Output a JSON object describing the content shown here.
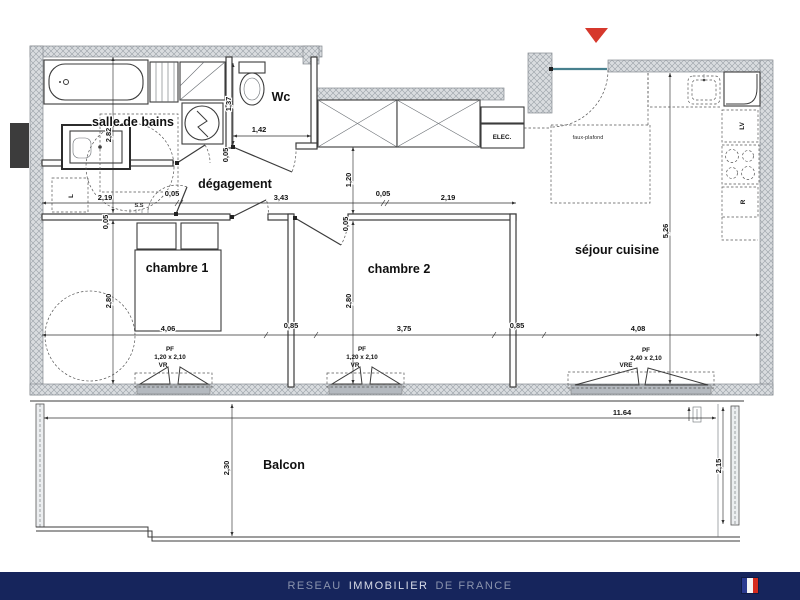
{
  "page": {
    "background": "#ffffff"
  },
  "entrance_marker": {
    "color": "#d6382c"
  },
  "rooms": {
    "salle_de_bains": "salle de bains",
    "wc": "Wc",
    "degagement": "dégagement",
    "chambre1": "chambre 1",
    "chambre2": "chambre 2",
    "sejour": "séjour cuisine",
    "balcon": "Balcon"
  },
  "labels": {
    "elec": "ELEC.",
    "faux_plafond": "faux-plafond",
    "dishwasher": "LV",
    "fridge": "R",
    "towel_rail": "S.S",
    "washer_slot": "L"
  },
  "windows": [
    {
      "code": "PF",
      "size": "1,20 x 2,10",
      "shutter": "VR"
    },
    {
      "code": "PF",
      "size": "1,20 x 2,10",
      "shutter": "VR"
    },
    {
      "code": "PF",
      "size": "2,40 x 2,10",
      "shutter": "VRE"
    }
  ],
  "dims": [
    "2,82",
    "2,19",
    "0,05",
    "3,43",
    "0,05",
    "2,19",
    "1,37",
    "1,42",
    "0,05",
    "1,20",
    "0,05",
    "0,05",
    "2,80",
    "2,80",
    "4,06",
    "0,85",
    "3,75",
    "0,85",
    "4,08",
    "5,26",
    "11.64",
    "2,30",
    "2,15"
  ],
  "footer": {
    "bg": "#16255c",
    "reseau": "RESEAU",
    "immobilier": "IMMOBILIER",
    "de_france": "DE FRANCE",
    "flag": {
      "blue": "#2a3a8f",
      "white": "#f4f4f4",
      "red": "#d52b1e"
    }
  }
}
